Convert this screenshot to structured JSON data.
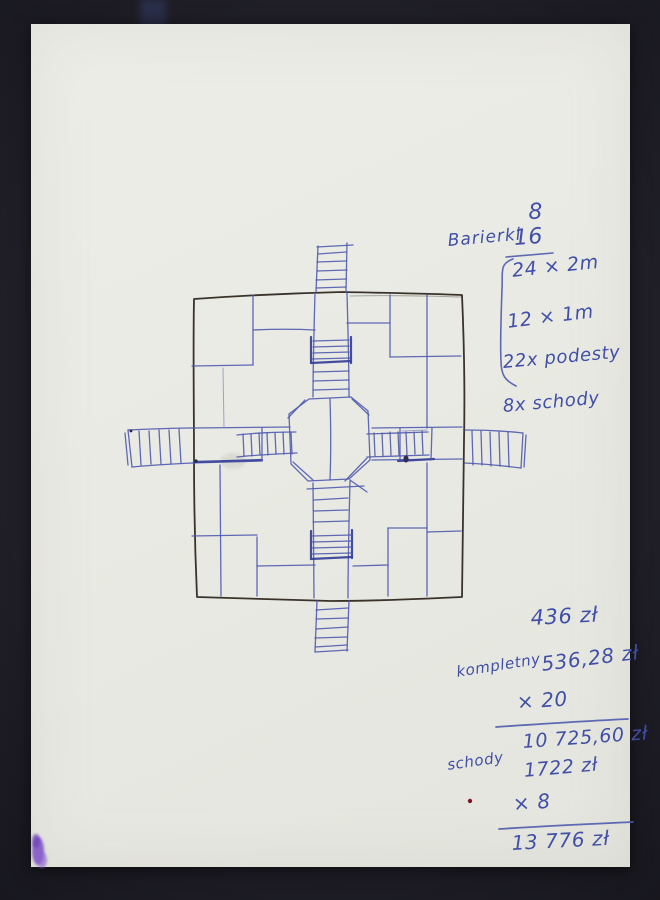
{
  "materials_note": {
    "qty_8": "8",
    "barierki_label": "Barierki",
    "qty_16": "16",
    "size_a": "24 × 2m",
    "size_b": "12 × 1m",
    "podesty_line": "22x podesty",
    "schody_line": "8x schody"
  },
  "price_calc": {
    "price_single": "436 zł",
    "komplet_label": "kompletny",
    "komplet_price": "536,28 zł",
    "multiply_20": "× 20",
    "subtotal": "10 725,60 zł",
    "schody_label": "schody",
    "schody_price": "1722 zł",
    "multiply_8": "× 8",
    "total": "13 776 zł"
  },
  "colors": {
    "backdrop": "#201f28",
    "paper": "#e9eae3",
    "pen_blue": "#4f5aae",
    "pen_black": "#3a332b",
    "smudge_violet": "#7b50c6",
    "dot_red": "#7d1626"
  }
}
